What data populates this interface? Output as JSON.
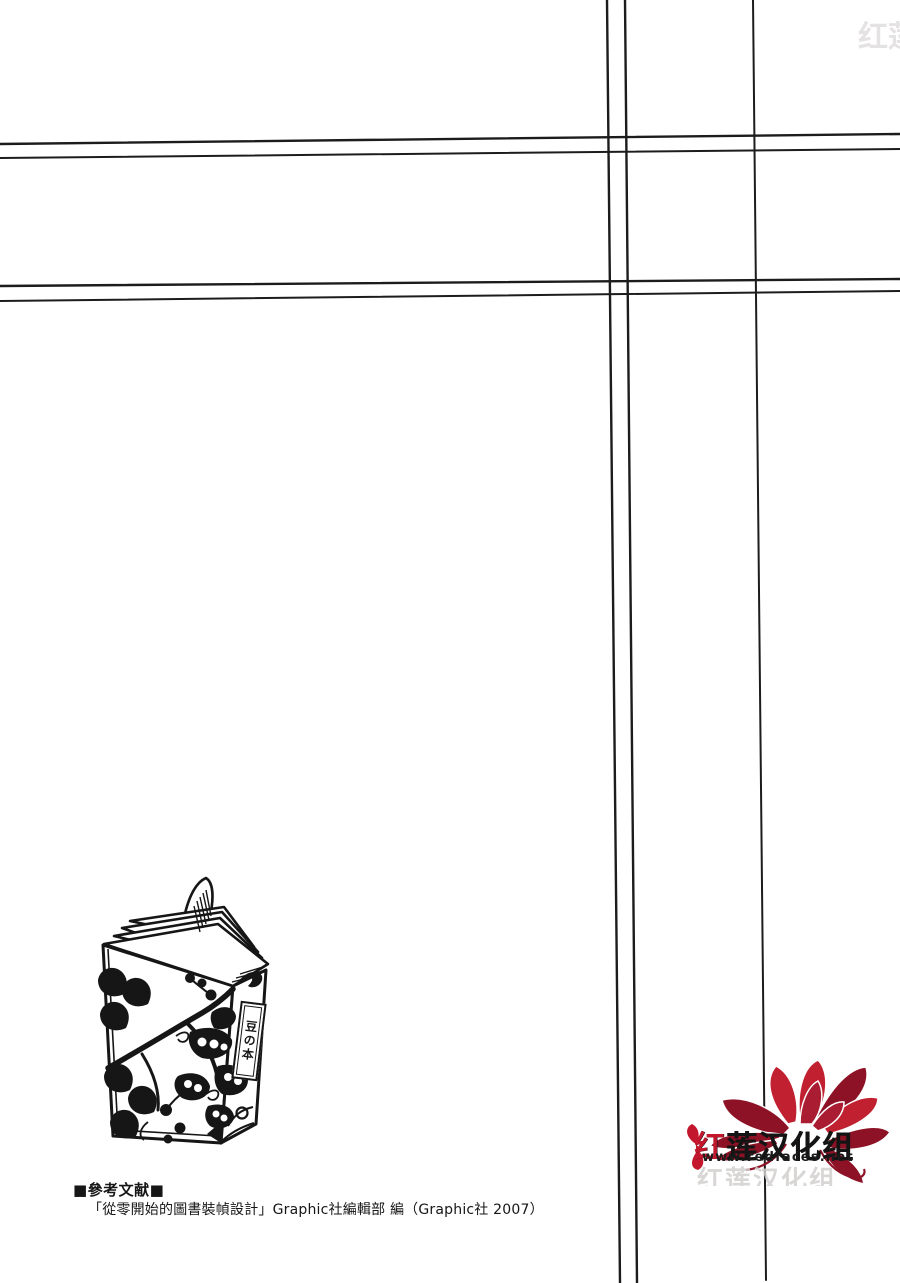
{
  "page": {
    "width": 900,
    "height": 1283,
    "background": "#ffffff",
    "line_color": "#1c1c1c"
  },
  "references": {
    "heading": "■參考文献■",
    "entry": "「從零開始的圖書裝幀設計」Graphic社編輯部 編（Graphic社 2007）"
  },
  "book": {
    "spine_label": "豆の本"
  },
  "logo": {
    "group_name": "红莲汉化组",
    "website": "www.redfaces.net",
    "ghost_text": "红莲汉化组",
    "colors": {
      "petal_dark": "#8e1226",
      "petal_mid": "#a91c31",
      "petal_bright": "#c0202f",
      "accent_red": "#c2172d",
      "text_black": "#141414",
      "ghost_gray": "#d3cfcf"
    }
  }
}
